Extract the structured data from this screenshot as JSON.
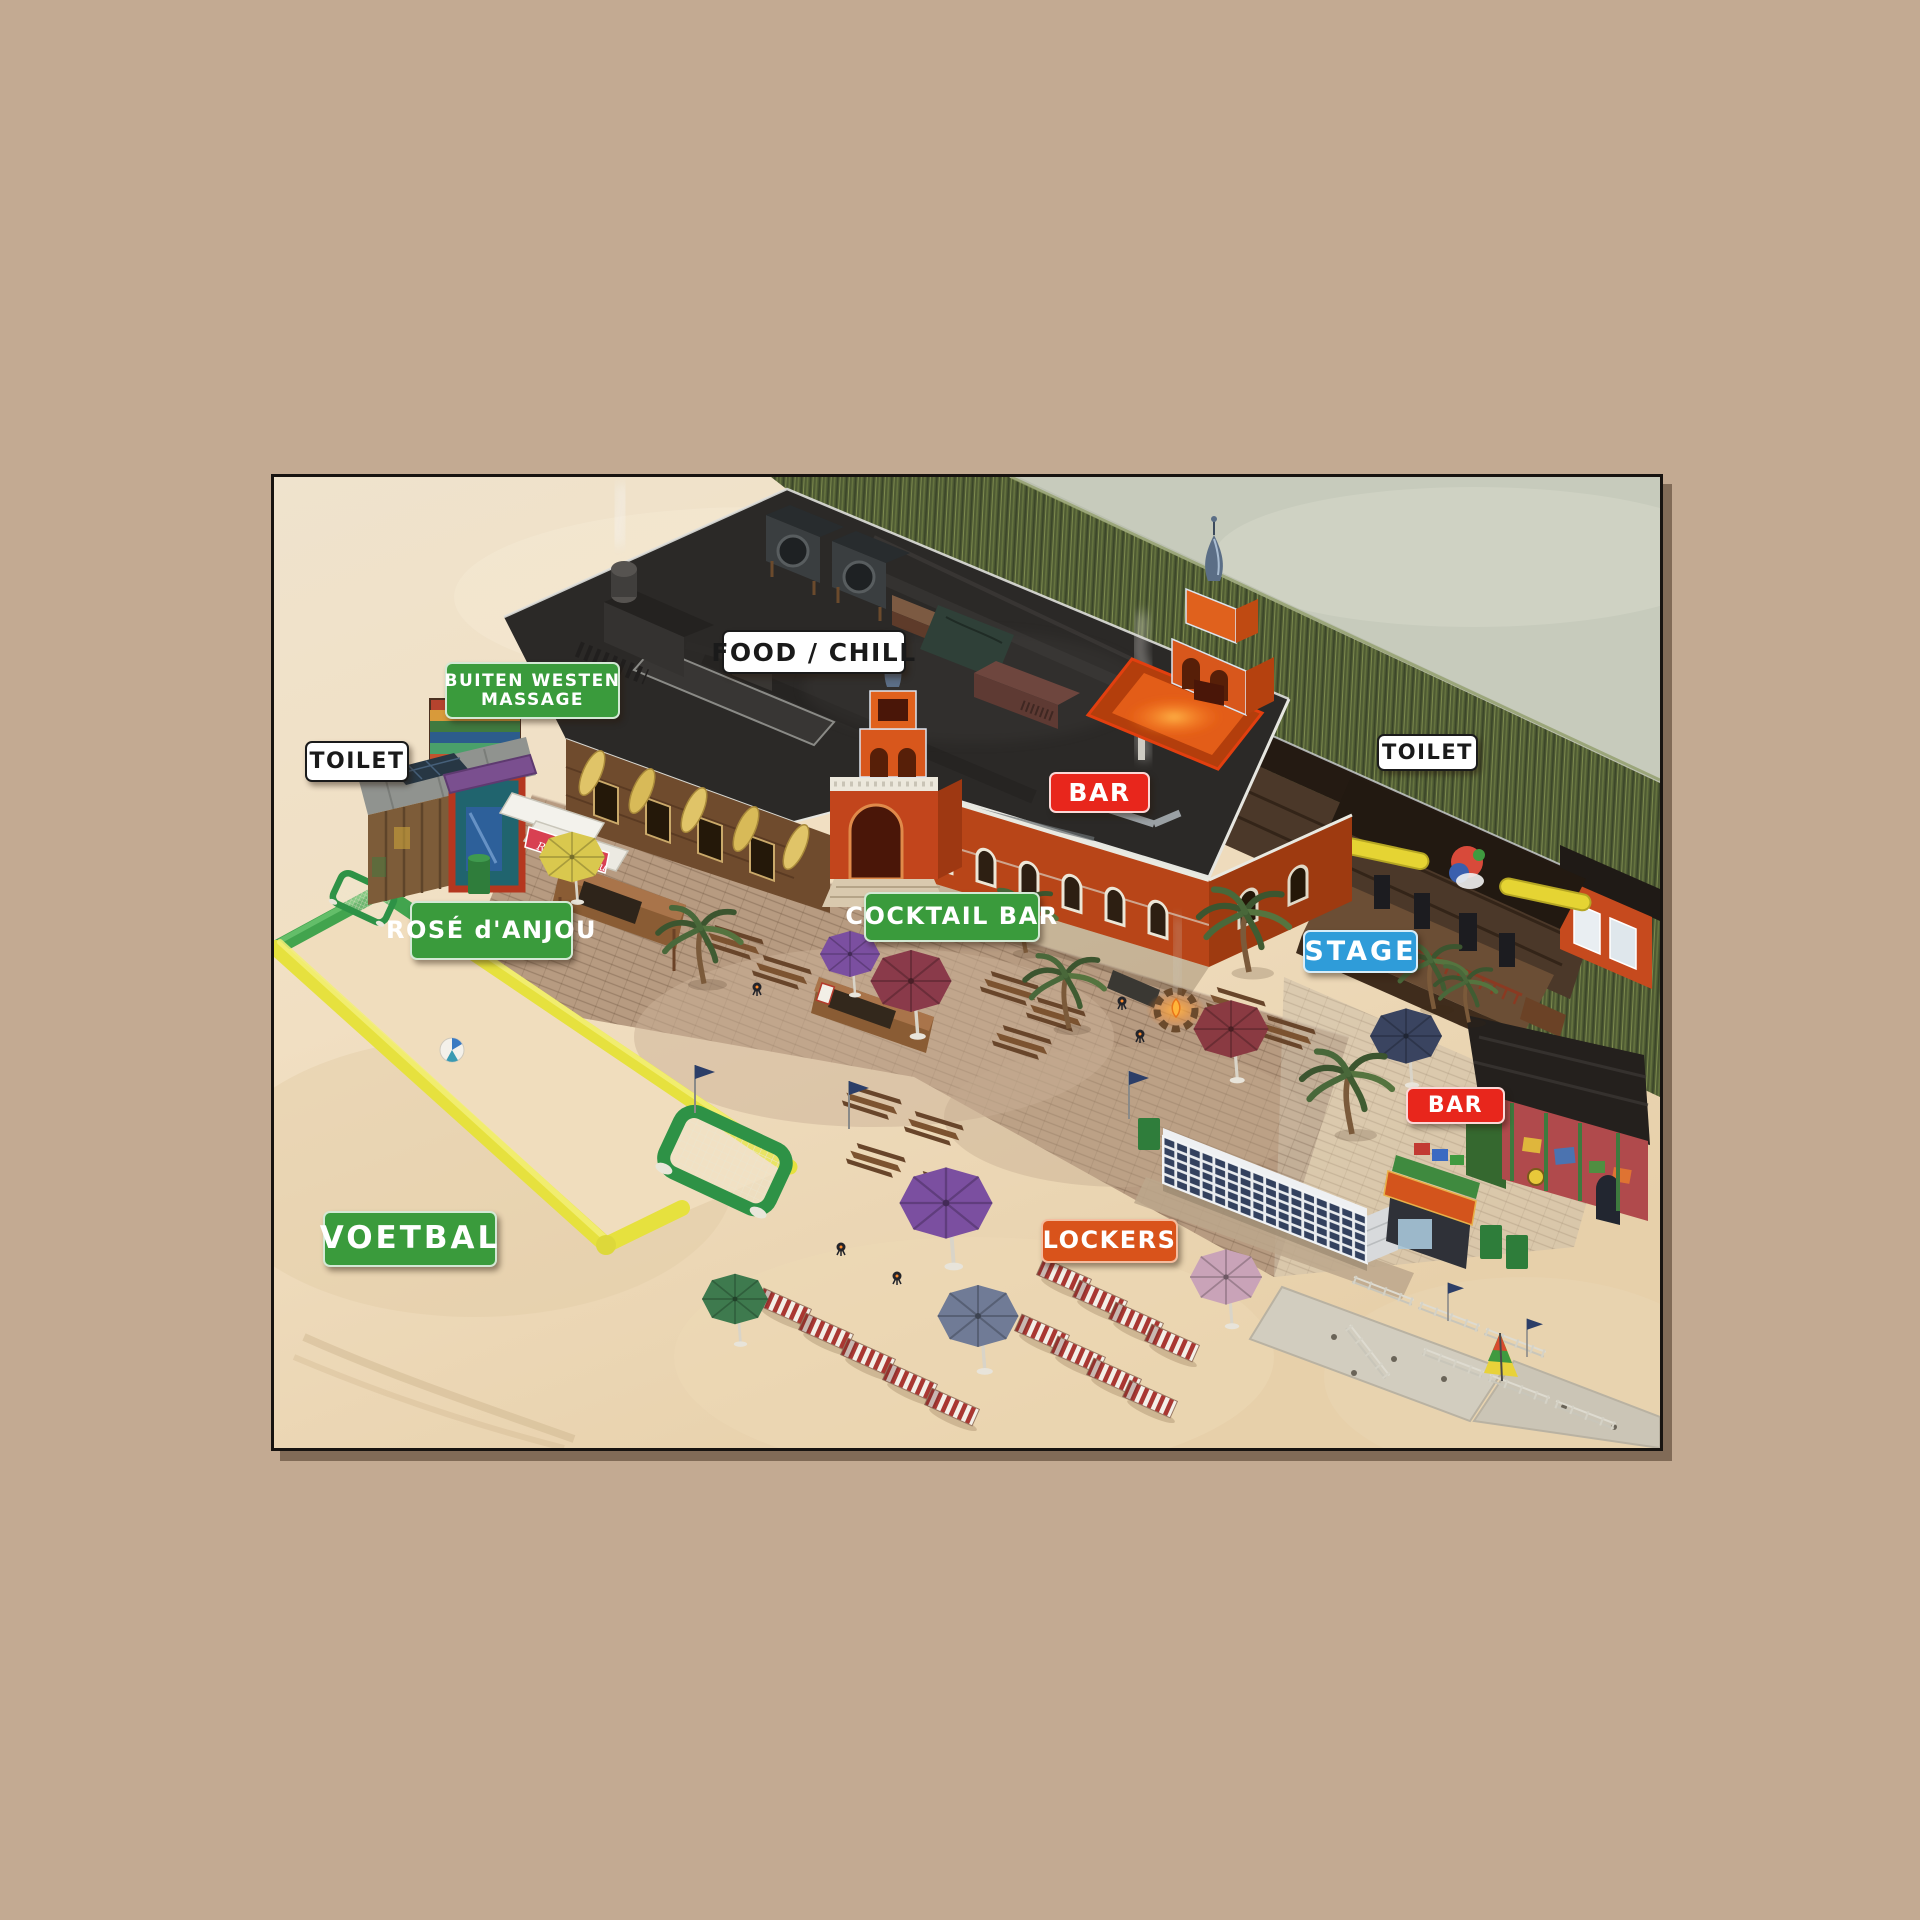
{
  "page": {
    "kind": "festival-beach-map-render"
  },
  "map": {
    "labels": {
      "food_chill": "FOOD / CHILL",
      "massage_line1": "BUITEN WESTEN",
      "massage_line2": "MASSAGE",
      "toilet_left": "TOILET",
      "toilet_right": "TOILET",
      "bar_roof": "BAR",
      "bar_entrance": "BAR",
      "rose_danjou": "ROSÉ d'ANJOU",
      "cocktail_bar": "COCKTAIL BAR",
      "stage": "STAGE",
      "voetbal": "VOETBAL",
      "lockers": "LOCKERS"
    },
    "stall_banner": "Rosé d'Anjou",
    "colors": {
      "page_bg": "#c3aa92",
      "label_green": "#3a9b3c",
      "label_red": "#e8261c",
      "label_blue": "#2f9cd9",
      "label_orange": "#d9531b",
      "label_white": "#ffffff",
      "sand": "#eddcc0",
      "grass": "#4e5a33",
      "water": "#c7cbbc",
      "roof_dark": "#2b2927",
      "brick_orange": "#b84518",
      "pitch_green_tube": "#42a44e",
      "pitch_yellow_tube": "#e6e13e"
    }
  }
}
